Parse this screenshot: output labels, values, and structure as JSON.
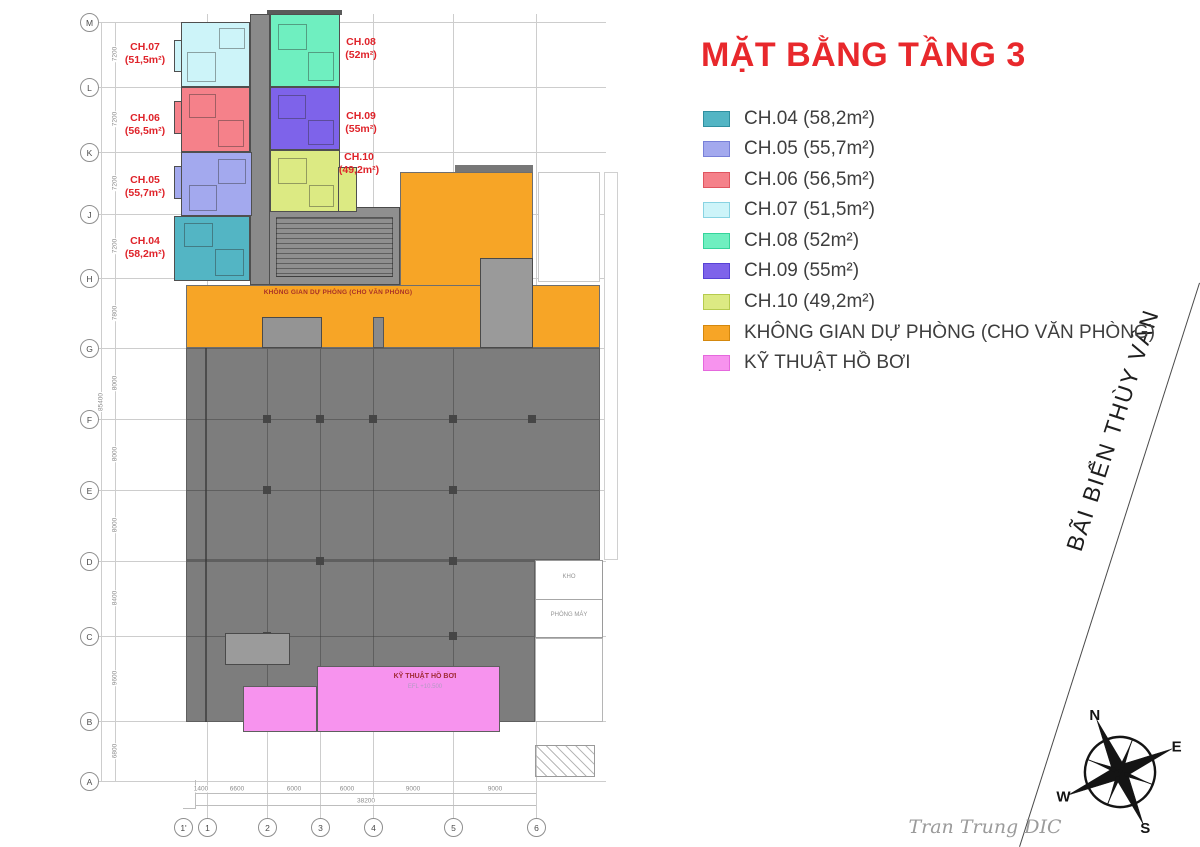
{
  "title": "MẶT BẰNG TẦNG 3",
  "legend": {
    "items": [
      {
        "label": "CH.04 (58,2m²)",
        "color": "#53b5c4",
        "border": "#2f8fa0"
      },
      {
        "label": "CH.05 (55,7m²)",
        "color": "#a3a9ee",
        "border": "#7880d8"
      },
      {
        "label": "CH.06 (56,5m²)",
        "color": "#f5818a",
        "border": "#e05560"
      },
      {
        "label": "CH.07 (51,5m²)",
        "color": "#cdf4f9",
        "border": "#88d3e2"
      },
      {
        "label": "CH.08 (52m²)",
        "color": "#6fefc0",
        "border": "#35d49b"
      },
      {
        "label": "CH.09 (55m²)",
        "color": "#7e63ea",
        "border": "#5742d6"
      },
      {
        "label": "CH.10 (49,2m²)",
        "color": "#dcea83",
        "border": "#b6cb4e"
      },
      {
        "label": "KHÔNG GIAN DỰ PHÒNG (CHO VĂN PHÒNG)",
        "color": "#f7a526",
        "border": "#d4880e"
      },
      {
        "label": "KỸ THUẬT HỒ BƠI",
        "color": "#f793ee",
        "border": "#e568dd"
      }
    ]
  },
  "units": {
    "ch04": {
      "name": "CH.04",
      "area": "(58,2m²)"
    },
    "ch05": {
      "name": "CH.05",
      "area": "(55,7m²)"
    },
    "ch06": {
      "name": "CH.06",
      "area": "(56,5m²)"
    },
    "ch07": {
      "name": "CH.07",
      "area": "(51,5m²)"
    },
    "ch08": {
      "name": "CH.08",
      "area": "(52m²)"
    },
    "ch09": {
      "name": "CH.09",
      "area": "(55m²)"
    },
    "ch10": {
      "name": "CH.10",
      "area": "(49,2m²)"
    }
  },
  "plan": {
    "orange_label": "KHÔNG GIAN DỰ PHÒNG (CHO VĂN PHÒNG)",
    "pink_label": "KỸ THUẬT HỒ BƠI",
    "pink_sublabel": "EFL +10.500",
    "room_labels": [
      "KHO",
      "PHÒNG MÁY"
    ]
  },
  "grid": {
    "row_ids": [
      "M",
      "L",
      "K",
      "J",
      "H",
      "G",
      "F",
      "E",
      "D",
      "C",
      "B",
      "A"
    ],
    "row_dims": [
      "7200",
      "7200",
      "7200",
      "7200",
      "7800",
      "8000",
      "8000",
      "8000",
      "8400",
      "9600",
      "6800"
    ],
    "row_total": "85400",
    "col_ids": [
      "1'",
      "1",
      "2",
      "3",
      "4",
      "5",
      "6"
    ],
    "col_dims": [
      "1400",
      "6600",
      "6000",
      "6000",
      "9000",
      "9000"
    ],
    "col_total": "38200"
  },
  "compass": {
    "n": "N",
    "e": "E",
    "s": "S",
    "w": "W"
  },
  "shoreline_label": "BÃI BIỂN THÙY VÂN",
  "signature": "Tran Trung DIC",
  "colors": {
    "title_red": "#e8282c",
    "unit_label_red": "#df232a"
  }
}
